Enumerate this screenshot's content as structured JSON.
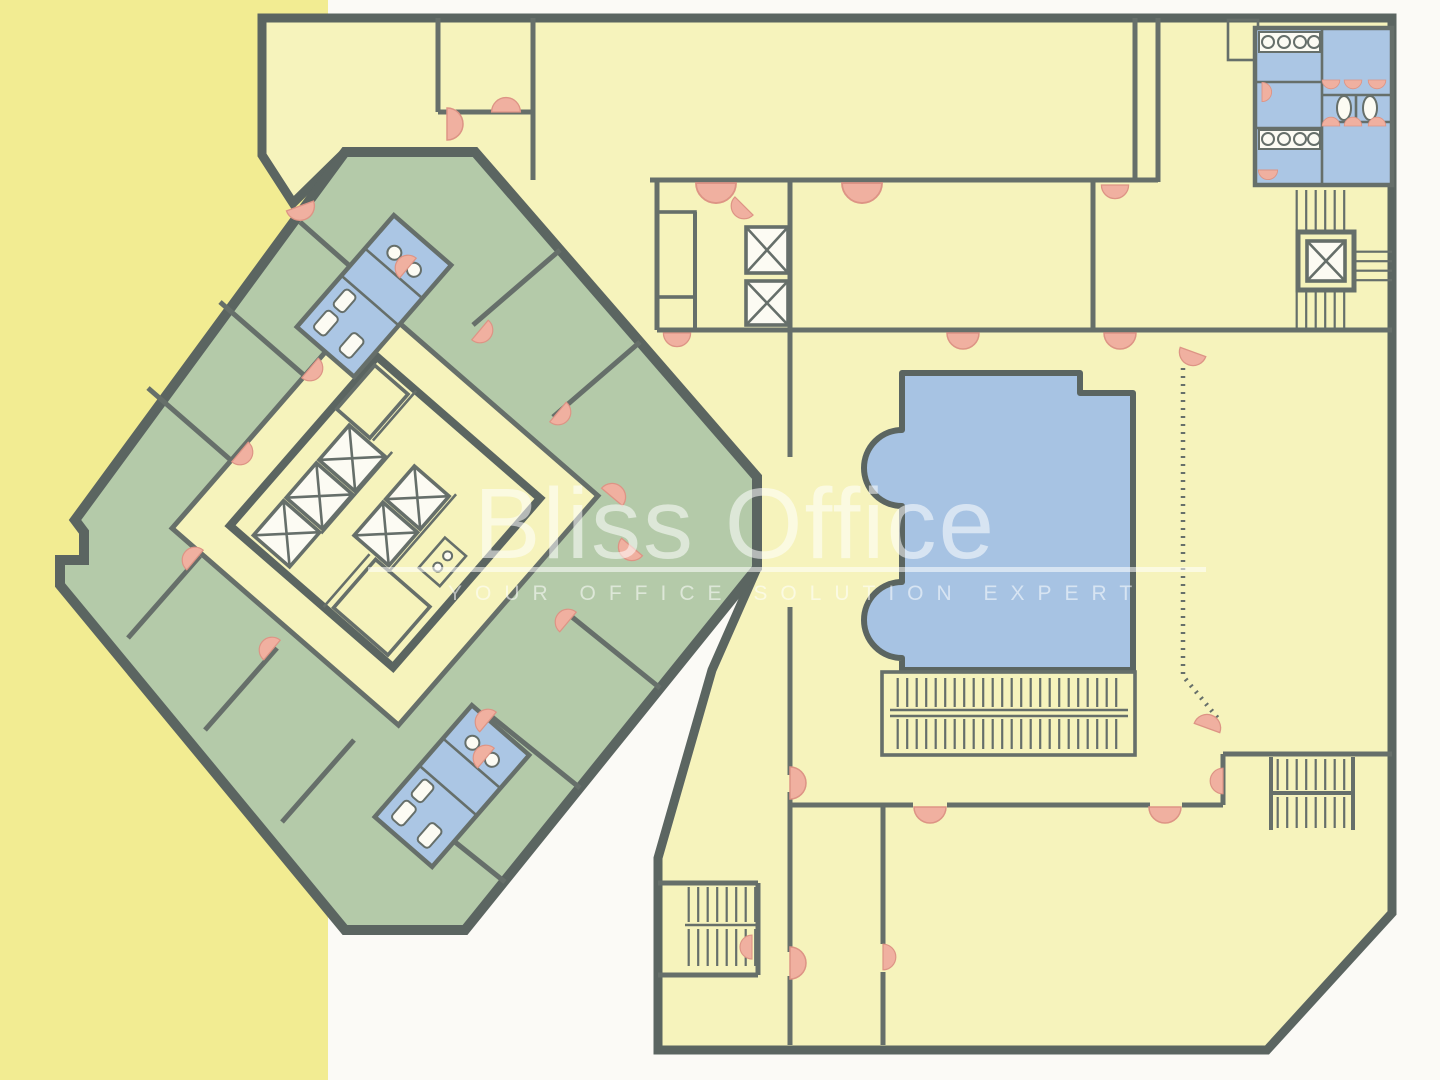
{
  "watermark": {
    "title": "Bliss Office",
    "subtitle": "YOUR OFFICE SOLUTION EXPERT"
  },
  "colors": {
    "page": "#fbfaf6",
    "strip": "#f2ec92",
    "yellow": "#f6f3bc",
    "green": "#b4caa9",
    "wall": "#5b6561",
    "wallthin": "#666f6a",
    "blue": "#a7c3e3",
    "bluebath": "#abc6e4",
    "salmon": "#f0b0a0",
    "white": "#fcfbf3"
  },
  "elements": {
    "tower_wing": "diamond-tower-wing",
    "podium_wing": "podium-wing",
    "pool": "pool-atrium",
    "core": "elevator-core",
    "restrooms": "restrooms",
    "stairs": "stairs",
    "doors": "door-swing-arcs"
  }
}
